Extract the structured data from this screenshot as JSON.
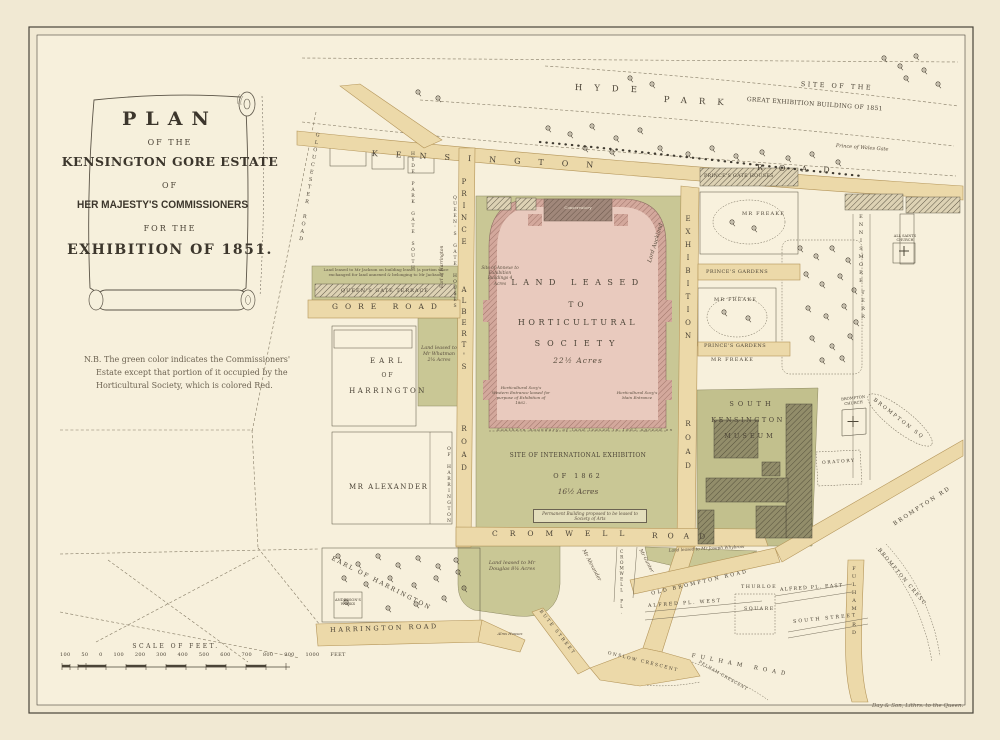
{
  "title_cartouche": {
    "l1": "PLAN",
    "l2": "OF THE",
    "l3": "KENSINGTON GORE ESTATE",
    "l4": "OF",
    "l5": "HER MAJESTY'S COMMISSIONERS",
    "l6": "FOR THE",
    "l7": "EXHIBITION OF 1851."
  },
  "note": {
    "l1": "N.B. The green color indicates the Commissioners'",
    "l2": "Estate except that portion of it occupied by the",
    "l3": "Horticultural Society, which is colored Red."
  },
  "hyde_park": {
    "hyde": "HYDE",
    "park": "PARK",
    "site1": "SITE OF THE",
    "site2": "GREAT EXHIBITION BUILDING OF 1851",
    "wales_gate": "Prince of Wales Gate"
  },
  "roads": {
    "kensington": "KENSINGTON",
    "kensington_rd": "ROAD",
    "prince1": "PRINCE",
    "prince2": "ALBERT'S",
    "prince3": "ROAD",
    "exhibition1": "EXHIBITION",
    "exhibition2": "ROAD",
    "gore": "GORE ROAD",
    "cromwell1": "CROMWELL",
    "cromwell2": "ROAD",
    "harrington": "HARRINGTON ROAD",
    "old_brompton": "OLD BROMPTON ROAD",
    "brompton_rd": "BROMPTON RD",
    "brompton_sq": "BROMPTON SQ",
    "brompton_cresc": "BROMPTON CRESC",
    "fulham_rd": "FULHAM RD",
    "fulham_road": "FULHAM ROAD",
    "cromwell_pl": "CROMWELL PL.",
    "bute": "BUTE STREET",
    "onslow": "ONSLOW CRESCENT",
    "pelham": "PELHAM CRESCENT",
    "alfred_west": "ALFRED PL. WEST",
    "alfred_east": "ALFRED PL. EAST",
    "south_street": "SOUTH STREET",
    "thurloe1": "THURLOE",
    "thurloe2": "SQUARE",
    "gloucester": "GLOUCESTER ROAD",
    "hp_gate_south": "HYDE PARK GATE SOUTH",
    "queens_gate_houses": "QUEEN'S GATE HOUSES",
    "earl_harrington_it": "Earl of Harrington",
    "of_harrington": "OF HARRINGTON",
    "ennismore1": "ENNISMORE",
    "ennismore2": "TERR.",
    "queens_gate_terrace": "QUEEN'S GATE TERRACE"
  },
  "parcels": {
    "hs1": "LAND LEASED",
    "hs2": "TO",
    "hs3": "HORTICULTURAL",
    "hs4": "SOCIETY",
    "hs_acres": "22½ Acres",
    "conservatory": "Conservatory",
    "annexe": "Site of Annexe to Exhibition Buildings 4 Acres",
    "west_entrance": "Horticultural Socy's Western Entrance leased for purpose of Exhibition of 1862.",
    "main_entrance": "Horticultural Socy's Main Entrance",
    "south_boundary": "Southern boundary of land leased in 1862 agreed on",
    "ie1": "SITE OF INTERNATIONAL EXHIBITION",
    "ie2": "OF 1862",
    "ie_acres": "16½ Acres",
    "permanent": "Permanent Building proposed to be leased to Society of Arts",
    "lord_auckland": "Lord Auckland",
    "princes_gate_houses": "PRINCE'S GATE HOUSES",
    "freake": "MR FREAKE",
    "princes_gardens": "PRINCE'S GARDENS",
    "whatman": "Land leased to Mr Whatman 2¼ Acres",
    "qgt_note": "Land leased to Mr Jackson on building leases (a portion since exchanged for land annexed & belonging to Mr Jackson)",
    "earl1": "EARL",
    "earl2": "OF",
    "earl3": "HARRINGTON",
    "alexander": "MR ALEXANDER",
    "earl_nursery": "EARL OF HARRINGTON",
    "anderson": "ANDERSON'S WORKS",
    "douglas": "Land leased to Mr Douglas 8¼ Acres",
    "alexander_it": "Mr Alexander",
    "gunter": "Mr Gunter",
    "whybrow": "Land leased to Mr Joseph Whybrow",
    "alms": "Alms Houses",
    "museum1": "SOUTH",
    "museum2": "KENSINGTON",
    "museum3": "MUSEUM",
    "brompton_church": "BROMPTON CHURCH",
    "oratory": "ORATORY",
    "all_saints": "ALL SAINTS CHURCH"
  },
  "scale": {
    "title": "SCALE OF FEET.",
    "ticks": "100 50 0 100 200 300 400 500 600 700 800 900 1000 FEET"
  },
  "imprint": "Day & Son, Lithrs. to the Queen.",
  "colors": {
    "commissioners_green": "#c9c795",
    "horticultural_pink": "#e9cabe",
    "road_buff": "#ecd9a9",
    "paper": "#f1e9d3"
  }
}
